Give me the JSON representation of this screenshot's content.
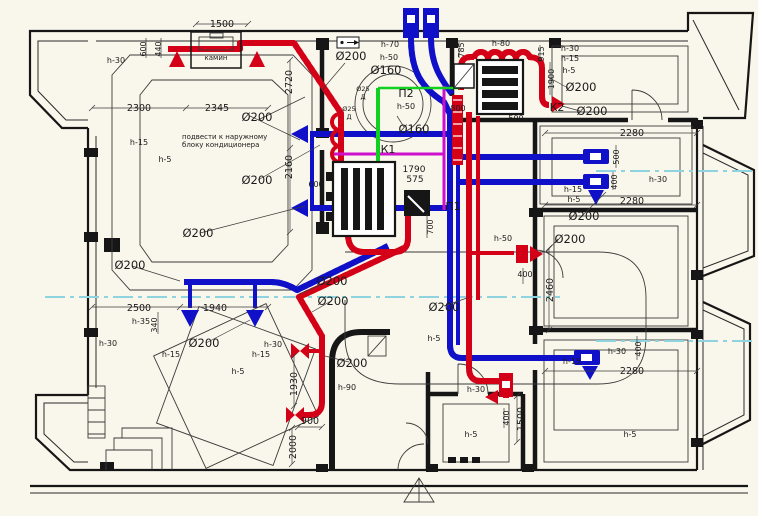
{
  "document": {
    "type": "Ventilation and air-conditioning duct layout floor plan",
    "language": "Russian"
  },
  "colors": {
    "background": "#f9f7eb",
    "walls": "#161616",
    "supply_duct_red": "#d40018",
    "exhaust_duct_blue": "#1010c8",
    "refrigerant_magenta": "#cc10cc",
    "sensor_green": "#10d020",
    "section_line_cyan": "#8fd2e0"
  },
  "systems": {
    "supply_unit_1": "П1",
    "supply_unit_2": "П2",
    "exhaust_1": "К1",
    "exhaust_2": "К2",
    "fireplace": "камин",
    "note": "подвести к наружному блоку кондиционера"
  },
  "labels": [
    {
      "text": "1500",
      "x": 222,
      "y": 27,
      "k": "dim"
    },
    {
      "text": "600",
      "x": 146,
      "y": 49,
      "k": "small",
      "rot": 1
    },
    {
      "text": "440",
      "x": 161,
      "y": 49,
      "k": "small",
      "rot": 1
    },
    {
      "text": "камин",
      "x": 216,
      "y": 60,
      "k": "note"
    },
    {
      "text": "h-30",
      "x": 116,
      "y": 63,
      "k": "h"
    },
    {
      "text": "2300",
      "x": 139,
      "y": 111,
      "k": "dim"
    },
    {
      "text": "2345",
      "x": 217,
      "y": 111,
      "k": "dim"
    },
    {
      "text": "2720",
      "x": 292,
      "y": 82,
      "k": "dim",
      "rot": 1
    },
    {
      "text": "2160",
      "x": 292,
      "y": 167,
      "k": "dim",
      "rot": 1
    },
    {
      "text": "подвести к наружному",
      "x": 182,
      "y": 139,
      "k": "note",
      "a": "s"
    },
    {
      "text": "блоку кондиционера",
      "x": 182,
      "y": 147,
      "k": "note",
      "a": "s"
    },
    {
      "text": "h-15",
      "x": 139,
      "y": 145,
      "k": "h"
    },
    {
      "text": "h-5",
      "x": 165,
      "y": 162,
      "k": "h"
    },
    {
      "text": "Ø200",
      "x": 257,
      "y": 121,
      "k": "dia"
    },
    {
      "text": "Ø200",
      "x": 257,
      "y": 184,
      "k": "dia"
    },
    {
      "text": "Ø200",
      "x": 198,
      "y": 237,
      "k": "dia"
    },
    {
      "text": "Ø200",
      "x": 130,
      "y": 269,
      "k": "dia"
    },
    {
      "text": "Ø200",
      "x": 204,
      "y": 347,
      "k": "dia"
    },
    {
      "text": "2500",
      "x": 139,
      "y": 311,
      "k": "dim"
    },
    {
      "text": "1940",
      "x": 215,
      "y": 311,
      "k": "dim"
    },
    {
      "text": "340",
      "x": 157,
      "y": 325,
      "k": "small",
      "rot": 1
    },
    {
      "text": "h-35",
      "x": 141,
      "y": 324,
      "k": "h"
    },
    {
      "text": "h-30",
      "x": 108,
      "y": 346,
      "k": "h"
    },
    {
      "text": "h-15",
      "x": 171,
      "y": 357,
      "k": "h"
    },
    {
      "text": "h-15",
      "x": 261,
      "y": 357,
      "k": "h"
    },
    {
      "text": "h-5",
      "x": 238,
      "y": 374,
      "k": "h"
    },
    {
      "text": "h-30",
      "x": 273,
      "y": 347,
      "k": "h"
    },
    {
      "text": "Ø200",
      "x": 351,
      "y": 60,
      "k": "dia"
    },
    {
      "text": "h-70",
      "x": 390,
      "y": 47,
      "k": "h"
    },
    {
      "text": "h-50",
      "x": 389,
      "y": 60,
      "k": "h"
    },
    {
      "text": "Ø160",
      "x": 386,
      "y": 74,
      "k": "dia"
    },
    {
      "text": "Ø25",
      "x": 363,
      "y": 91,
      "k": "tiny"
    },
    {
      "text": "Д",
      "x": 363,
      "y": 99,
      "k": "tiny"
    },
    {
      "text": "Ø25",
      "x": 349,
      "y": 111,
      "k": "tiny"
    },
    {
      "text": "Д",
      "x": 349,
      "y": 119,
      "k": "tiny"
    },
    {
      "text": "П2",
      "x": 406,
      "y": 97,
      "k": "sys"
    },
    {
      "text": "h-50",
      "x": 406,
      "y": 109,
      "k": "h"
    },
    {
      "text": "Ø160",
      "x": 414,
      "y": 133,
      "k": "dia"
    },
    {
      "text": "К1",
      "x": 388,
      "y": 153,
      "k": "sys"
    },
    {
      "text": "1790",
      "x": 414,
      "y": 172,
      "k": "num9"
    },
    {
      "text": "575",
      "x": 415,
      "y": 182,
      "k": "num9"
    },
    {
      "text": "П1",
      "x": 453,
      "y": 210,
      "k": "sys"
    },
    {
      "text": "700",
      "x": 433,
      "y": 227,
      "k": "small",
      "rot": 1
    },
    {
      "text": "600",
      "x": 316,
      "y": 187,
      "k": "small"
    },
    {
      "text": "785",
      "x": 464,
      "y": 50,
      "k": "small",
      "rot": 1
    },
    {
      "text": "800",
      "x": 458,
      "y": 111,
      "k": "small"
    },
    {
      "text": "500",
      "x": 516,
      "y": 121,
      "k": "small"
    },
    {
      "text": "h-80",
      "x": 501,
      "y": 46,
      "k": "h"
    },
    {
      "text": "915",
      "x": 544,
      "y": 54,
      "k": "small",
      "rot": 1
    },
    {
      "text": "1900",
      "x": 554,
      "y": 79,
      "k": "small",
      "rot": 1
    },
    {
      "text": "h-30",
      "x": 570,
      "y": 51,
      "k": "h"
    },
    {
      "text": "h-15",
      "x": 570,
      "y": 61,
      "k": "h"
    },
    {
      "text": "h-5",
      "x": 569,
      "y": 73,
      "k": "h"
    },
    {
      "text": "Ø200",
      "x": 581,
      "y": 91,
      "k": "dia"
    },
    {
      "text": "К2",
      "x": 557,
      "y": 111,
      "k": "sys"
    },
    {
      "text": "Ø200",
      "x": 592,
      "y": 115,
      "k": "dia"
    },
    {
      "text": "2280",
      "x": 632,
      "y": 136,
      "k": "dim"
    },
    {
      "text": "500",
      "x": 619,
      "y": 157,
      "k": "small",
      "rot": 1
    },
    {
      "text": "400",
      "x": 617,
      "y": 182,
      "k": "small",
      "rot": 1
    },
    {
      "text": "h-30",
      "x": 658,
      "y": 182,
      "k": "h"
    },
    {
      "text": "h-15",
      "x": 573,
      "y": 192,
      "k": "h"
    },
    {
      "text": "h-5",
      "x": 574,
      "y": 202,
      "k": "h"
    },
    {
      "text": "2280",
      "x": 632,
      "y": 204,
      "k": "dim"
    },
    {
      "text": "Ø200",
      "x": 584,
      "y": 220,
      "k": "dia"
    },
    {
      "text": "Ø200",
      "x": 570,
      "y": 243,
      "k": "dia"
    },
    {
      "text": "h-50",
      "x": 503,
      "y": 241,
      "k": "h"
    },
    {
      "text": "400",
      "x": 525,
      "y": 277,
      "k": "small"
    },
    {
      "text": "2460",
      "x": 553,
      "y": 290,
      "k": "dim",
      "rot": 1
    },
    {
      "text": "Ø200",
      "x": 332,
      "y": 285,
      "k": "dia"
    },
    {
      "text": "Ø200",
      "x": 333,
      "y": 305,
      "k": "dia"
    },
    {
      "text": "Ø200",
      "x": 352,
      "y": 367,
      "k": "dia"
    },
    {
      "text": "Ø200",
      "x": 444,
      "y": 311,
      "k": "dia"
    },
    {
      "text": "h-5",
      "x": 434,
      "y": 341,
      "k": "h"
    },
    {
      "text": "h-90",
      "x": 347,
      "y": 390,
      "k": "h"
    },
    {
      "text": "1930",
      "x": 297,
      "y": 384,
      "k": "dim",
      "rot": 1
    },
    {
      "text": "900",
      "x": 310,
      "y": 424,
      "k": "dim"
    },
    {
      "text": "2000",
      "x": 296,
      "y": 447,
      "k": "dim",
      "rot": 1
    },
    {
      "text": "h-30",
      "x": 476,
      "y": 392,
      "k": "h"
    },
    {
      "text": "h-5",
      "x": 471,
      "y": 437,
      "k": "h"
    },
    {
      "text": "400",
      "x": 509,
      "y": 418,
      "k": "small",
      "rot": 1
    },
    {
      "text": "1500",
      "x": 524,
      "y": 419,
      "k": "dim",
      "rot": 1
    },
    {
      "text": "h-15",
      "x": 572,
      "y": 364,
      "k": "h"
    },
    {
      "text": "h-30",
      "x": 617,
      "y": 354,
      "k": "h"
    },
    {
      "text": "400",
      "x": 641,
      "y": 349,
      "k": "small",
      "rot": 1
    },
    {
      "text": "2280",
      "x": 632,
      "y": 374,
      "k": "dim"
    },
    {
      "text": "h-5",
      "x": 630,
      "y": 437,
      "k": "h"
    }
  ]
}
